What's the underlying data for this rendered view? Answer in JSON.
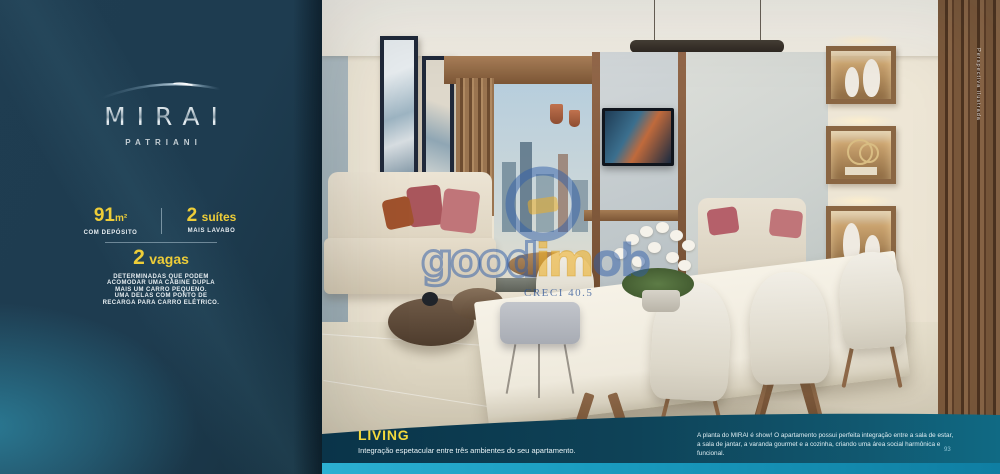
{
  "brand": {
    "name": "MIRAI",
    "subname": "PATRIANI"
  },
  "specs": {
    "area_value": "91",
    "area_unit": "m²",
    "area_note": "COM DEPÓSITO",
    "suites_value": "2",
    "suites_label": "suítes",
    "suites_note": "MAIS LAVABO",
    "parking_value": "2",
    "parking_label": "vagas",
    "parking_lines": [
      "DETERMINADAS QUE PODEM",
      "ACOMODAR UMA CABINE DUPLA",
      "MAIS UM CARRO PEQUENO.",
      "UMA DELAS COM PONTO DE",
      "RECARGA PARA CARRO ELÉTRICO."
    ]
  },
  "footer": {
    "section_title": "LIVING",
    "section_subtitle": "Integração espetacular entre três ambientes do seu apartamento.",
    "description_line1": "A planta do MIRAI é show! O apartamento possui perfeita integração entre a sala de estar,",
    "description_line2": "a sala de jantar, a varanda gourmet e a cozinha, criando uma área social harmônica e funcional.",
    "page_number": "93"
  },
  "watermark": {
    "part1": "good",
    "part2": "im",
    "part3": "ob",
    "creci": "CRECI 40.5"
  },
  "photo": {
    "credit": "Perspectiva ilustrada"
  },
  "colors": {
    "accent_yellow": "#eecd38",
    "panel_teal": "#1e3c50",
    "band_teal": "#0e4257",
    "bar_cyan": "#1a9cc0",
    "watermark_blue": "#305ea8",
    "watermark_yellow": "#ecae26"
  }
}
